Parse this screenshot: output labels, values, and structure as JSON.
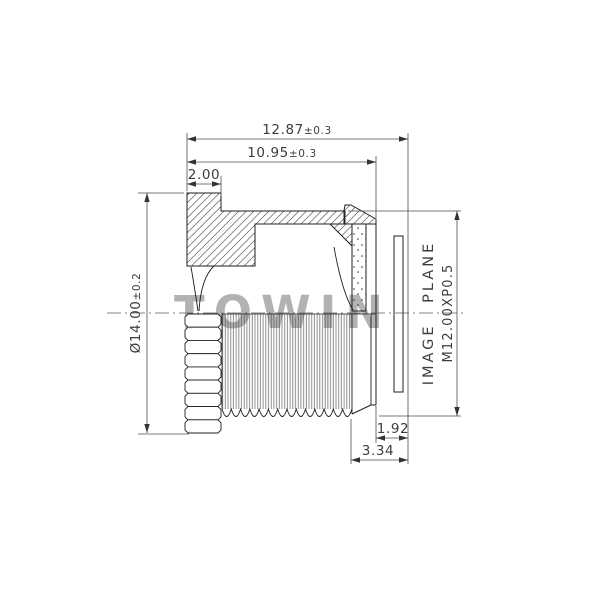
{
  "drawing": {
    "title_hint": "M12 lens barrel cross-section",
    "watermark": "TOWIN",
    "dim_overall_length": {
      "value": "12.87",
      "tol": "±0.3"
    },
    "dim_barrel_length": {
      "value": "10.95",
      "tol": "±0.3"
    },
    "dim_flange_thickness": {
      "value": "2.00"
    },
    "dim_outer_diameter": {
      "value": "Ø14.00",
      "tol": "±0.2"
    },
    "thread_spec": "M12.00XP0.5",
    "image_plane_label": "IMAGE PLANE",
    "dim_back_focus": {
      "value": "1.92"
    },
    "dim_glass_to_image": {
      "value": "3.34"
    }
  }
}
